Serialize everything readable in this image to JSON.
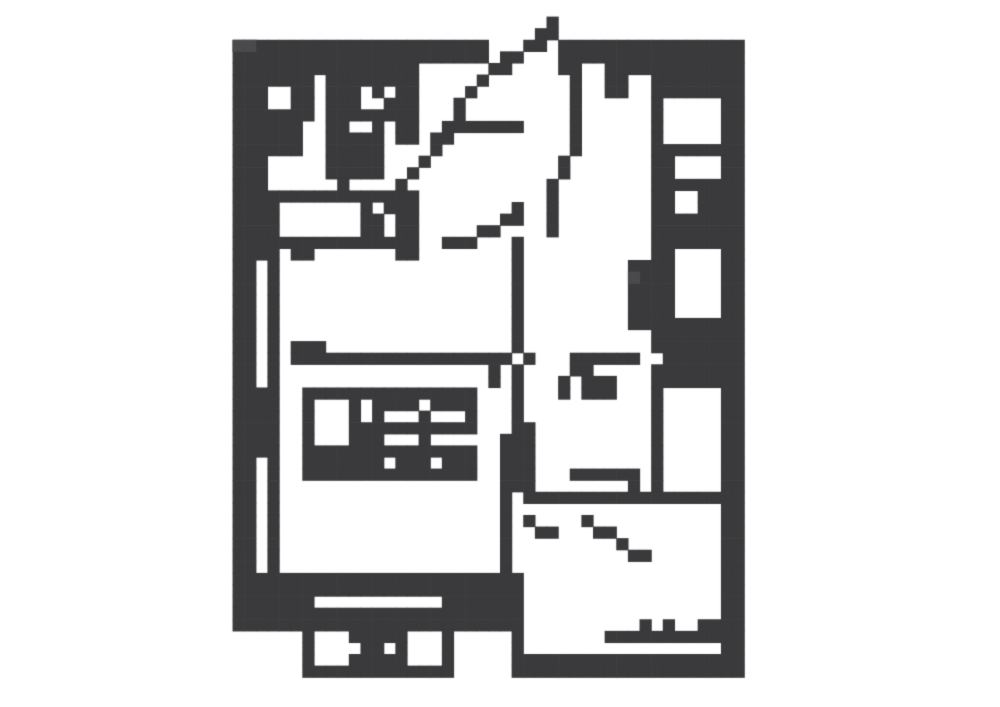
{
  "page": {
    "width": 1000,
    "height": 707,
    "background": "#ffffff",
    "description": "Pixelated black-and-white apartment floor plan diagram, no text"
  },
  "floor_plan": {
    "type": "pixel-grid-floor-plan",
    "ink": "#3a3a3c",
    "ink_light": "#4a4a4c",
    "background": "#ffffff",
    "grid_cols": 86,
    "grid_rows": 61,
    "col_offset": 20,
    "cell_width": 11.6279,
    "cell_height": 11.59,
    "offset_x": 0,
    "offset_y": 5,
    "rows": [
      "00000000000000000000000000000000000000000000",
      "00000000000000000000000000010000000000000000",
      "00000000000000000000000000110000000000000000",
      "11111111111111111111110001101111111111111111",
      "11111111111111111111110110001111111111111111",
      "11111111111111110000001100001100111111111111",
      "11111110111111110000010000000100110011111111",
      "11100110111010110000100000000100110011111111",
      "11100110111001110001000000000100000010000011",
      "11111110111111110001000000000100000010000011",
      "11111100110010110011111110000100000010000011",
      "11111100111110110110000000000100000010000011",
      "11111100111110000100000000000100000011111111",
      "11100000111110001000000000001000000011000011",
      "11100000111110010000000000001000000011000011",
      "11100000010000100000000000010000000011111111",
      "11111111111111110000000000010000000011001111",
      "11110000000101110000000010010000000011001111",
      "11110000000110110000000110010000000011111111",
      "11110000000110110000011000010000000011111111",
      "11111111111111110011100010000000000011111111",
      "11110110000000110000000010000000000011000011",
      "11010000000000000000000010000000001111000011",
      "11010000000000000000000010000000001111000011",
      "11010000000000000000000010000000001111000011",
      "11010000000000000000000010000000001111000011",
      "11010000000000000000000010000000001111000011",
      "11010000000000000000000010000000001111111111",
      "11010000000000000000000010000000000011111111",
      "11010111000000000000000010000000000011111111",
      "11010111111111111111111101000111111001111111",
      "11010000000000000000001010000110000011111111",
      "11010000000000000000001010001011100011111111",
      "11110011111111111111100010001011100010000011",
      "11110010001011110111100010000000000010000011",
      "11110010001010001000100010000000000010000011",
      "11110010001111111111100011000000000010000011",
      "11110010001110001000000111000000000010000011",
      "11110011111111111111100111000000000010000011",
      "11010011111110111011100111000000000010000011",
      "11010011111111111111100111000111111010000011",
      "11010000000000000000000111000000001010000011",
      "11010000000000000000000101111111111111111111",
      "11010000000000000000000100000000000000000011",
      "11010000000000000000000101000010000000000011",
      "11010000000000000000000100110001100000000011",
      "11010000000000000000000100000000010000000011",
      "11010000000000000000000100000000001100000011",
      "11010000000000000000000100000000000000000011",
      "11111111111111111111111110000000000000000011",
      "11111111111111111111111110000000000000000011",
      "11111110000000000011111110000000000000000011",
      "11111111111111111111111110000000000000000011",
      "11111111111111111111111110000000000101001111",
      "00000010001111100010000010000000111111111111",
      "00000010000110100010000010000000000000000011",
      "00000010001111100010000011111111111111111111",
      "00000011111111111110000011111111111111111111",
      "00000000000000000000000000000000000000000000",
      "00000000000000000000000000000000000000000000",
      "00000000000000000000000000000000000000000000"
    ],
    "light_cells": [
      [
        20,
        3
      ],
      [
        21,
        3
      ],
      [
        54,
        23
      ]
    ]
  }
}
